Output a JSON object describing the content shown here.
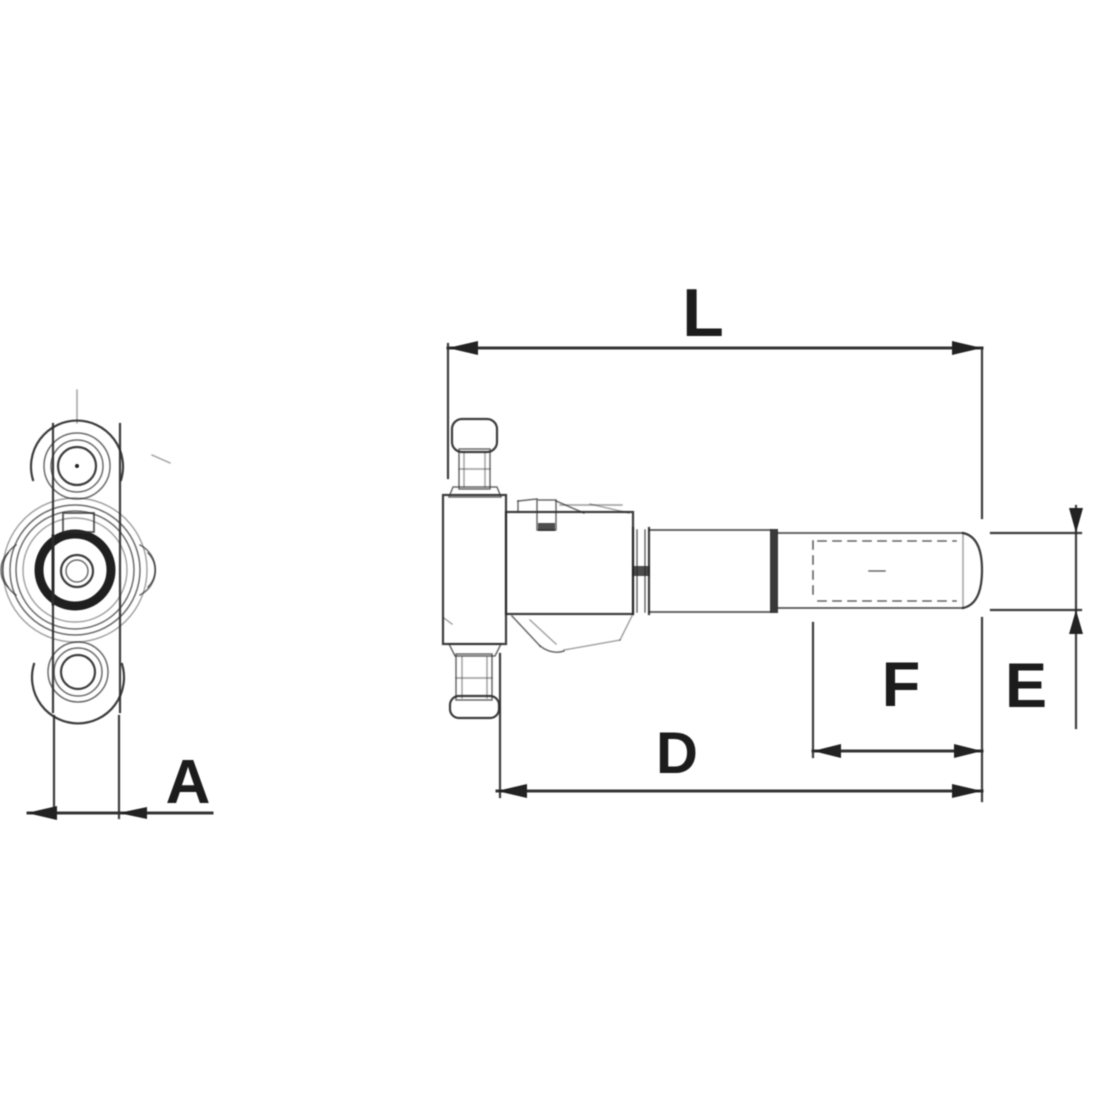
{
  "page": {
    "background": "#ffffff"
  },
  "palette": {
    "ink": "#2d2d2d",
    "label": "#1b1b1b"
  },
  "dimension_labels": {
    "L": "L",
    "A": "A",
    "D": "D",
    "E": "E",
    "F": "F"
  }
}
